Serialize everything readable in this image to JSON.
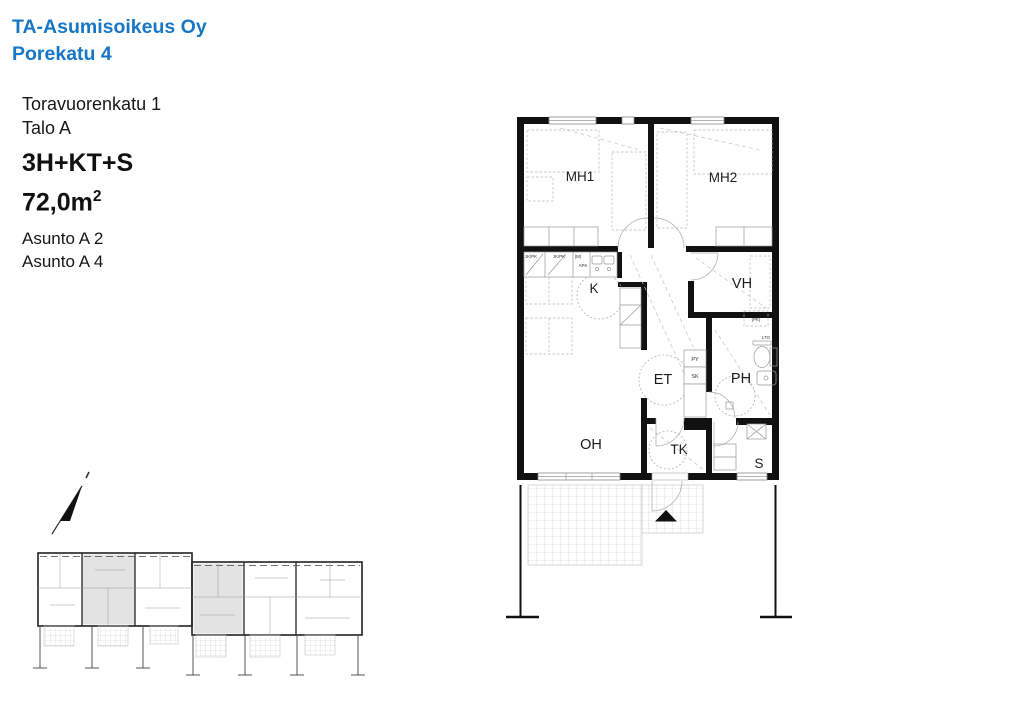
{
  "header": {
    "company": "TA-Asumisoikeus Oy",
    "project": "Porekatu 4"
  },
  "info": {
    "address": "Toravuorenkatu 1",
    "building": "Talo A",
    "apartment_type": "3H+KT+S",
    "area_value": "72,0m",
    "area_sup": "2",
    "unit1": "Asunto A 2",
    "unit2": "Asunto A 4"
  },
  "colors": {
    "accent_blue": "#1777c4",
    "wall_black": "#111111",
    "highlight_gray": "#e3e3e3"
  },
  "plan": {
    "rooms": {
      "mh1": "MH1",
      "mh2": "MH2",
      "k": "K",
      "vh": "VH",
      "et": "ET",
      "ph": "PH",
      "oh": "OH",
      "tk": "TK",
      "s": "S"
    },
    "labels": {
      "jkpk1": "JK/PK",
      "jkpk2": "JK/PK",
      "m": "(M)",
      "apk": "APK",
      "py": "PY",
      "sk": "SK",
      "pk": "(PK)",
      "lto": "LTO"
    }
  }
}
